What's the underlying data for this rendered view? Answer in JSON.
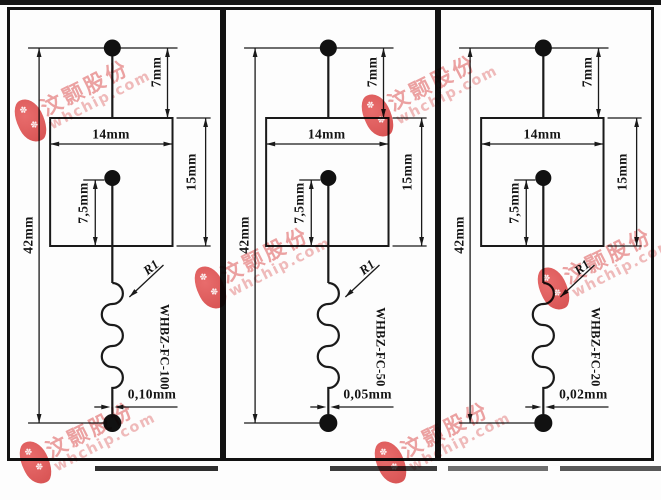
{
  "page": {
    "background": "#fdfdfd",
    "line_color": "#1a1a1a"
  },
  "watermark": {
    "brand_cn": "汶颢股份",
    "brand_domain": "whchip.com",
    "blob_color": "#d85252",
    "cn_text_color": "#eda2a2",
    "domain_text_color": "#f1bcbc"
  },
  "panels": [
    {
      "part_number": "WHBZ-FC-100",
      "radius_label": "R1",
      "wire_diameter": "0,10mm",
      "dims": {
        "top_lead": "7mm",
        "body_width": "14mm",
        "body_height": "15mm",
        "inner_lead": "7,5mm",
        "overall_height": "42mm"
      }
    },
    {
      "part_number": "WHBZ-FC-50",
      "radius_label": "R1",
      "wire_diameter": "0,05mm",
      "dims": {
        "top_lead": "7mm",
        "body_width": "14mm",
        "body_height": "15mm",
        "inner_lead": "7,5mm",
        "overall_height": "42mm"
      }
    },
    {
      "part_number": "WHBZ-FC-20",
      "radius_label": "R1",
      "wire_diameter": "0,02mm",
      "dims": {
        "top_lead": "7mm",
        "body_width": "14mm",
        "body_height": "15mm",
        "inner_lead": "7,5mm",
        "overall_height": "42mm"
      }
    }
  ]
}
